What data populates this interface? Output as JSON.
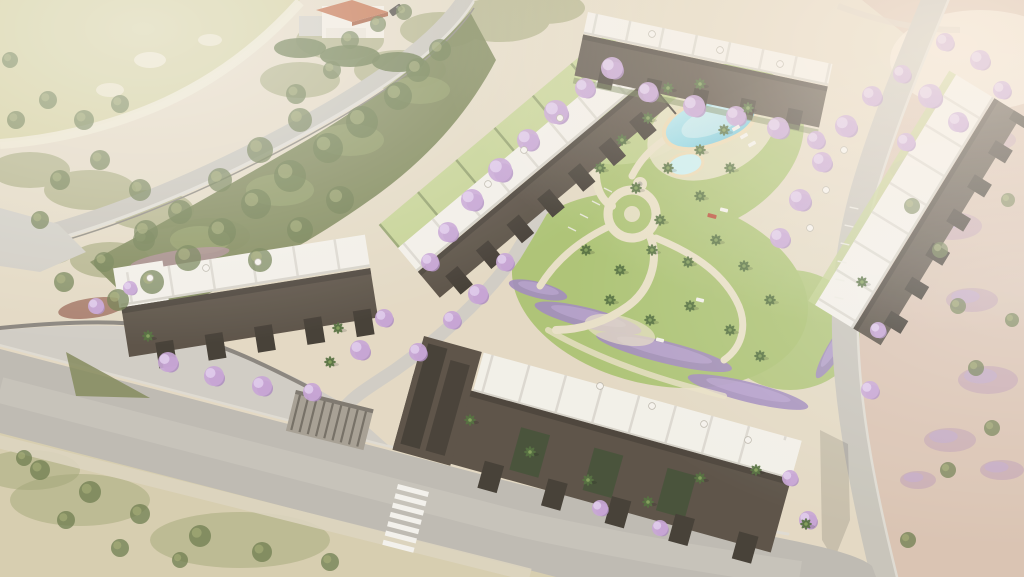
{
  "meta": {
    "description": "Aerial architectural rendering of a hillside residential complex with five apartment blocks, white roof terraces, a free-form swimming pool with kids pool, landscaped gardens with palm and jacaranda trees, lavender beds, perimeter roads with a zebra crossing, a detached house by the upper road, and surrounding dry scrubland"
  },
  "colors": {
    "base_sand": "#e3d9c3",
    "field_green": "#d3cf9e",
    "field_ring": "#ece5cf",
    "scrub_mid": "#9aa06c",
    "scrub_light": "#aab076",
    "tree_green": "#667747",
    "veg_band": "#75814f",
    "veg_band_light": "#93a066",
    "lawn": "#aac271",
    "lawn_light": "#c0d18d",
    "path_sand": "#e8e0c6",
    "road_grey": "#c6c3ba",
    "road_main": "#bcb9b1",
    "road_light": "#cfccc4",
    "wall_light": "#dedbd2",
    "wall_dark": "#85817a",
    "white_roof": "#f3f1ea",
    "roof_shade": "#d5d2c9",
    "facade": "#544b40",
    "facade_dark": "#3c362e",
    "jacaranda": "#c5a3d6",
    "jacaranda_light": "#e0cdee",
    "jacaranda_deep": "#a987c0",
    "lavender": "#9d87bd",
    "lavender_light": "#bca6d4",
    "palm": "#4d6a38",
    "palm_light": "#7d9b55",
    "mauve": "#c2a3b2",
    "pool_edge": "#ead9b2",
    "pool_water": "#8fd8e8",
    "pool_deep": "#55b9d6",
    "pool_shallow": "#c8f0f4",
    "house_roof": "#c4714b",
    "house_wall": "#f2ece0",
    "terrain_pink": "#d9c2b1",
    "scrub_bottom": "#d6cdae",
    "crosswalk": "#f4f3ee",
    "red_accent": "#b5452f"
  },
  "scene": {
    "jacarandas": [
      [
        612,
        68,
        11
      ],
      [
        585,
        88,
        10
      ],
      [
        556,
        112,
        12
      ],
      [
        528,
        140,
        11
      ],
      [
        500,
        170,
        12
      ],
      [
        472,
        200,
        11
      ],
      [
        448,
        232,
        10
      ],
      [
        430,
        262,
        9
      ],
      [
        505,
        262,
        9
      ],
      [
        478,
        294,
        10
      ],
      [
        452,
        320,
        9
      ],
      [
        648,
        92,
        10
      ],
      [
        694,
        106,
        11
      ],
      [
        736,
        116,
        10
      ],
      [
        778,
        128,
        11
      ],
      [
        816,
        140,
        9
      ],
      [
        780,
        238,
        10
      ],
      [
        800,
        200,
        11
      ],
      [
        822,
        162,
        10
      ],
      [
        846,
        126,
        11
      ],
      [
        872,
        96,
        10
      ],
      [
        902,
        74,
        9
      ],
      [
        930,
        96,
        12
      ],
      [
        958,
        122,
        10
      ],
      [
        980,
        60,
        10
      ],
      [
        1002,
        90,
        9
      ],
      [
        945,
        42,
        9
      ],
      [
        906,
        142,
        9
      ],
      [
        878,
        330,
        8
      ],
      [
        870,
        390,
        9
      ],
      [
        808,
        520,
        9
      ],
      [
        790,
        478,
        8
      ],
      [
        168,
        362,
        10
      ],
      [
        214,
        376,
        10
      ],
      [
        262,
        386,
        10
      ],
      [
        312,
        392,
        9
      ],
      [
        360,
        350,
        10
      ],
      [
        384,
        318,
        9
      ],
      [
        96,
        306,
        8
      ],
      [
        130,
        288,
        7
      ],
      [
        418,
        352,
        9
      ],
      [
        600,
        508,
        8
      ],
      [
        660,
        528,
        8
      ]
    ],
    "palms": [
      [
        668,
        88
      ],
      [
        700,
        84
      ],
      [
        648,
        118
      ],
      [
        622,
        140
      ],
      [
        600,
        168
      ],
      [
        636,
        188
      ],
      [
        668,
        168
      ],
      [
        700,
        150
      ],
      [
        724,
        130
      ],
      [
        748,
        108
      ],
      [
        730,
        168
      ],
      [
        700,
        196
      ],
      [
        660,
        220
      ],
      [
        586,
        250
      ],
      [
        620,
        270
      ],
      [
        652,
        250
      ],
      [
        688,
        262
      ],
      [
        716,
        240
      ],
      [
        744,
        266
      ],
      [
        610,
        300
      ],
      [
        650,
        320
      ],
      [
        690,
        306
      ],
      [
        730,
        330
      ],
      [
        770,
        300
      ],
      [
        760,
        356
      ],
      [
        470,
        420
      ],
      [
        530,
        452
      ],
      [
        588,
        480
      ],
      [
        648,
        502
      ],
      [
        700,
        478
      ],
      [
        756,
        470
      ],
      [
        806,
        524
      ],
      [
        862,
        282
      ],
      [
        148,
        336
      ],
      [
        338,
        328
      ],
      [
        330,
        362
      ]
    ],
    "green_trees": [
      [
        398,
        96,
        14
      ],
      [
        362,
        122,
        16
      ],
      [
        328,
        148,
        15
      ],
      [
        290,
        176,
        16
      ],
      [
        256,
        204,
        15
      ],
      [
        222,
        232,
        14
      ],
      [
        188,
        258,
        13
      ],
      [
        152,
        282,
        12
      ],
      [
        118,
        300,
        11
      ],
      [
        418,
        70,
        12
      ],
      [
        440,
        50,
        11
      ],
      [
        300,
        120,
        12
      ],
      [
        260,
        150,
        13
      ],
      [
        220,
        180,
        12
      ],
      [
        180,
        212,
        12
      ],
      [
        144,
        240,
        11
      ],
      [
        104,
        262,
        10
      ],
      [
        64,
        282,
        10
      ],
      [
        340,
        200,
        14
      ],
      [
        300,
        230,
        13
      ],
      [
        260,
        260,
        12
      ],
      [
        60,
        180,
        10
      ],
      [
        100,
        160,
        10
      ],
      [
        140,
        190,
        11
      ],
      [
        40,
        220,
        9
      ],
      [
        146,
        232,
        12
      ],
      [
        40,
        470,
        10
      ],
      [
        90,
        492,
        11
      ],
      [
        140,
        514,
        10
      ],
      [
        200,
        536,
        11
      ],
      [
        262,
        552,
        10
      ],
      [
        330,
        562,
        9
      ],
      [
        66,
        520,
        9
      ],
      [
        120,
        548,
        9
      ],
      [
        24,
        458,
        8
      ],
      [
        180,
        560,
        8
      ],
      [
        912,
        206,
        8
      ],
      [
        940,
        250,
        8
      ],
      [
        958,
        306,
        8
      ],
      [
        976,
        368,
        8
      ],
      [
        992,
        428,
        8
      ],
      [
        948,
        470,
        8
      ],
      [
        908,
        540,
        8
      ],
      [
        1008,
        200,
        7
      ],
      [
        1012,
        320,
        7
      ],
      [
        16,
        120,
        9
      ],
      [
        48,
        100,
        9
      ],
      [
        84,
        120,
        10
      ],
      [
        120,
        104,
        9
      ],
      [
        350,
        40,
        9
      ],
      [
        378,
        24,
        8
      ],
      [
        404,
        12,
        8
      ],
      [
        332,
        70,
        9
      ],
      [
        296,
        94,
        10
      ],
      [
        10,
        60,
        8
      ]
    ],
    "mauve_patches": [
      [
        916,
        170,
        26,
        12
      ],
      [
        952,
        226,
        30,
        14
      ],
      [
        972,
        300,
        26,
        12
      ],
      [
        988,
        380,
        30,
        14
      ],
      [
        950,
        440,
        26,
        12
      ],
      [
        1002,
        470,
        22,
        10
      ],
      [
        996,
        140,
        20,
        10
      ],
      [
        918,
        480,
        18,
        9
      ]
    ],
    "lavender_beds": [
      [
        588,
        318,
        55,
        10,
        14
      ],
      [
        664,
        352,
        70,
        11,
        14
      ],
      [
        748,
        392,
        62,
        10,
        14
      ],
      [
        838,
        344,
        40,
        8,
        -58
      ],
      [
        862,
        300,
        30,
        7,
        -58
      ],
      [
        538,
        290,
        30,
        8,
        14
      ]
    ],
    "roof_umbrellas": [
      [
        560,
        118
      ],
      [
        524,
        150
      ],
      [
        488,
        184
      ],
      [
        150,
        278
      ],
      [
        206,
        268
      ],
      [
        258,
        262
      ],
      [
        600,
        386
      ],
      [
        652,
        406
      ],
      [
        704,
        424
      ],
      [
        748,
        440
      ],
      [
        844,
        150
      ],
      [
        826,
        190
      ],
      [
        810,
        228
      ],
      [
        652,
        34
      ],
      [
        720,
        50
      ],
      [
        780,
        64
      ]
    ],
    "pool_loungers": [
      [
        736,
        128,
        -30
      ],
      [
        744,
        136,
        -30
      ],
      [
        752,
        144,
        -30
      ],
      [
        724,
        210,
        14
      ],
      [
        700,
        300,
        14
      ],
      [
        660,
        340,
        14
      ]
    ],
    "red_lounger": [
      712,
      216,
      14
    ],
    "parking_dashes": [
      [
        608,
        190,
        27
      ],
      [
        596,
        203,
        27
      ],
      [
        584,
        216,
        27
      ],
      [
        572,
        229,
        27
      ],
      [
        854,
        208,
        12
      ],
      [
        849,
        226,
        12
      ],
      [
        845,
        244,
        12
      ],
      [
        842,
        262,
        12
      ],
      [
        840,
        280,
        12
      ],
      [
        839,
        298,
        12
      ]
    ],
    "crosswalk": {
      "stripes": 7
    }
  }
}
